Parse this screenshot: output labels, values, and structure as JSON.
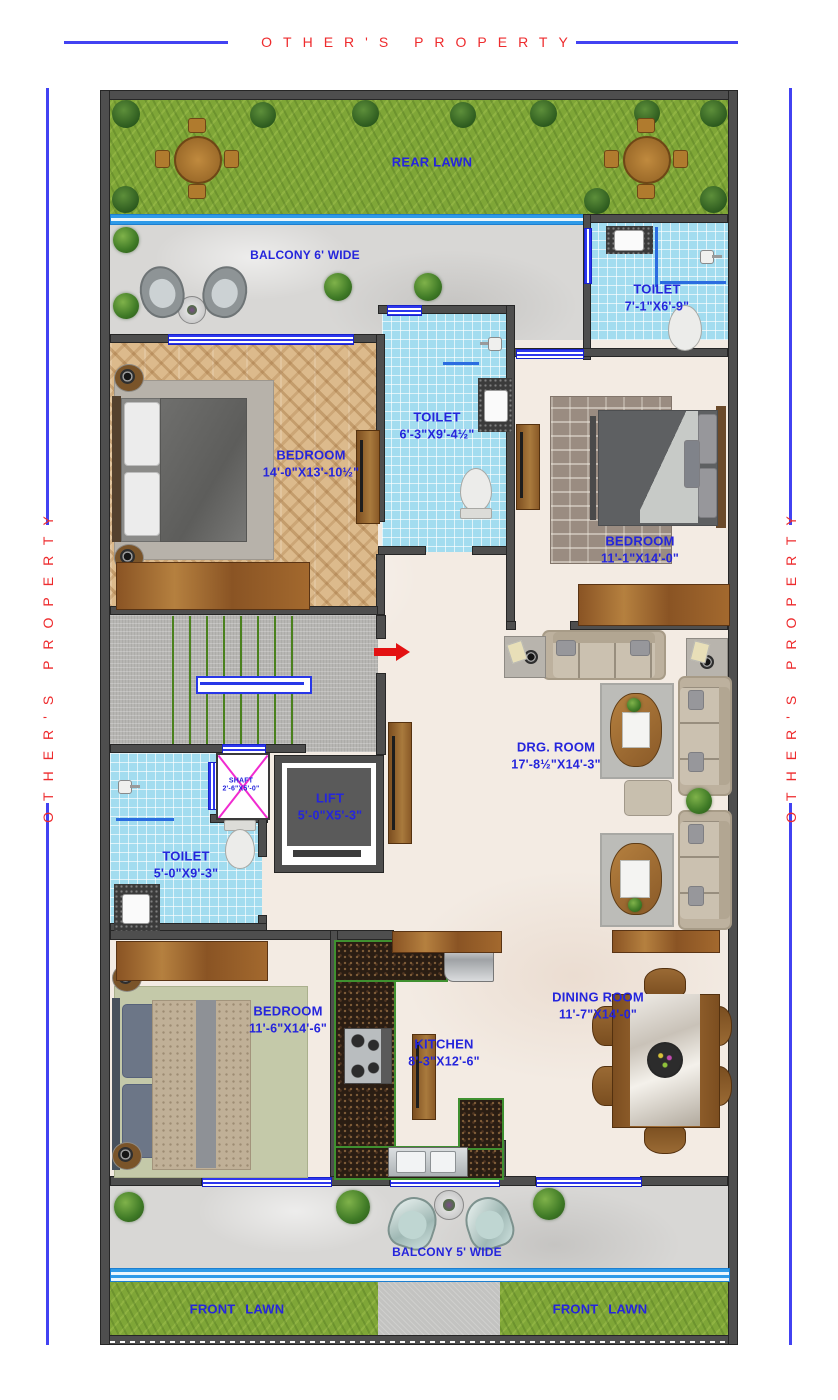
{
  "boundary": {
    "top": "OTHER'S PROPERTY",
    "left": "OTHER'S PROPERTY",
    "right": "OTHER'S PROPERTY"
  },
  "outdoor": {
    "rear_lawn": "REAR LAWN",
    "balcony_top": "BALCONY 6' WIDE",
    "balcony_bottom": "BALCONY 5' WIDE",
    "front_lawn_left": "FRONT LAWN",
    "front_lawn_right": "FRONT LAWN"
  },
  "rooms": {
    "toilet_top_right": {
      "name": "TOILET",
      "dims": "7'-1\"X6'-9\""
    },
    "bedroom_left": {
      "name": "BEDROOM",
      "dims": "14'-0\"X13'-10½\""
    },
    "toilet_mid": {
      "name": "TOILET",
      "dims": "6'-3\"X9'-4½\""
    },
    "bedroom_right": {
      "name": "BEDROOM",
      "dims": "11'-1\"X14'-0\""
    },
    "drg_room": {
      "name": "DRG. ROOM",
      "dims": "17'-8½\"X14'-3\""
    },
    "shaft": {
      "name": "SHAFT",
      "dims": "2'-6\"X5'-0\""
    },
    "lift": {
      "name": "LIFT",
      "dims": "5'-0\"X5'-3\""
    },
    "toilet_bottom": {
      "name": "TOILET",
      "dims": "5'-0\"X9'-3\""
    },
    "bedroom_bottom": {
      "name": "BEDROOM",
      "dims": "11'-6\"X14'-6\""
    },
    "kitchen": {
      "name": "KITCHEN",
      "dims": "8'-3\"X12'-6\""
    },
    "dining_room": {
      "name": "DINING ROOM",
      "dims": "11'-7\"X14'-0\""
    }
  },
  "colors": {
    "label_blue": "#2525dc",
    "property_red": "#ee2b2d",
    "line_blue": "#4242f2",
    "wall_gray": "#4e4e4e",
    "tile_blue": "#a2dcef",
    "grass_green": "#7fa637",
    "granite_border_green": "#3f9030",
    "entry_arrow_red": "#e31112"
  }
}
